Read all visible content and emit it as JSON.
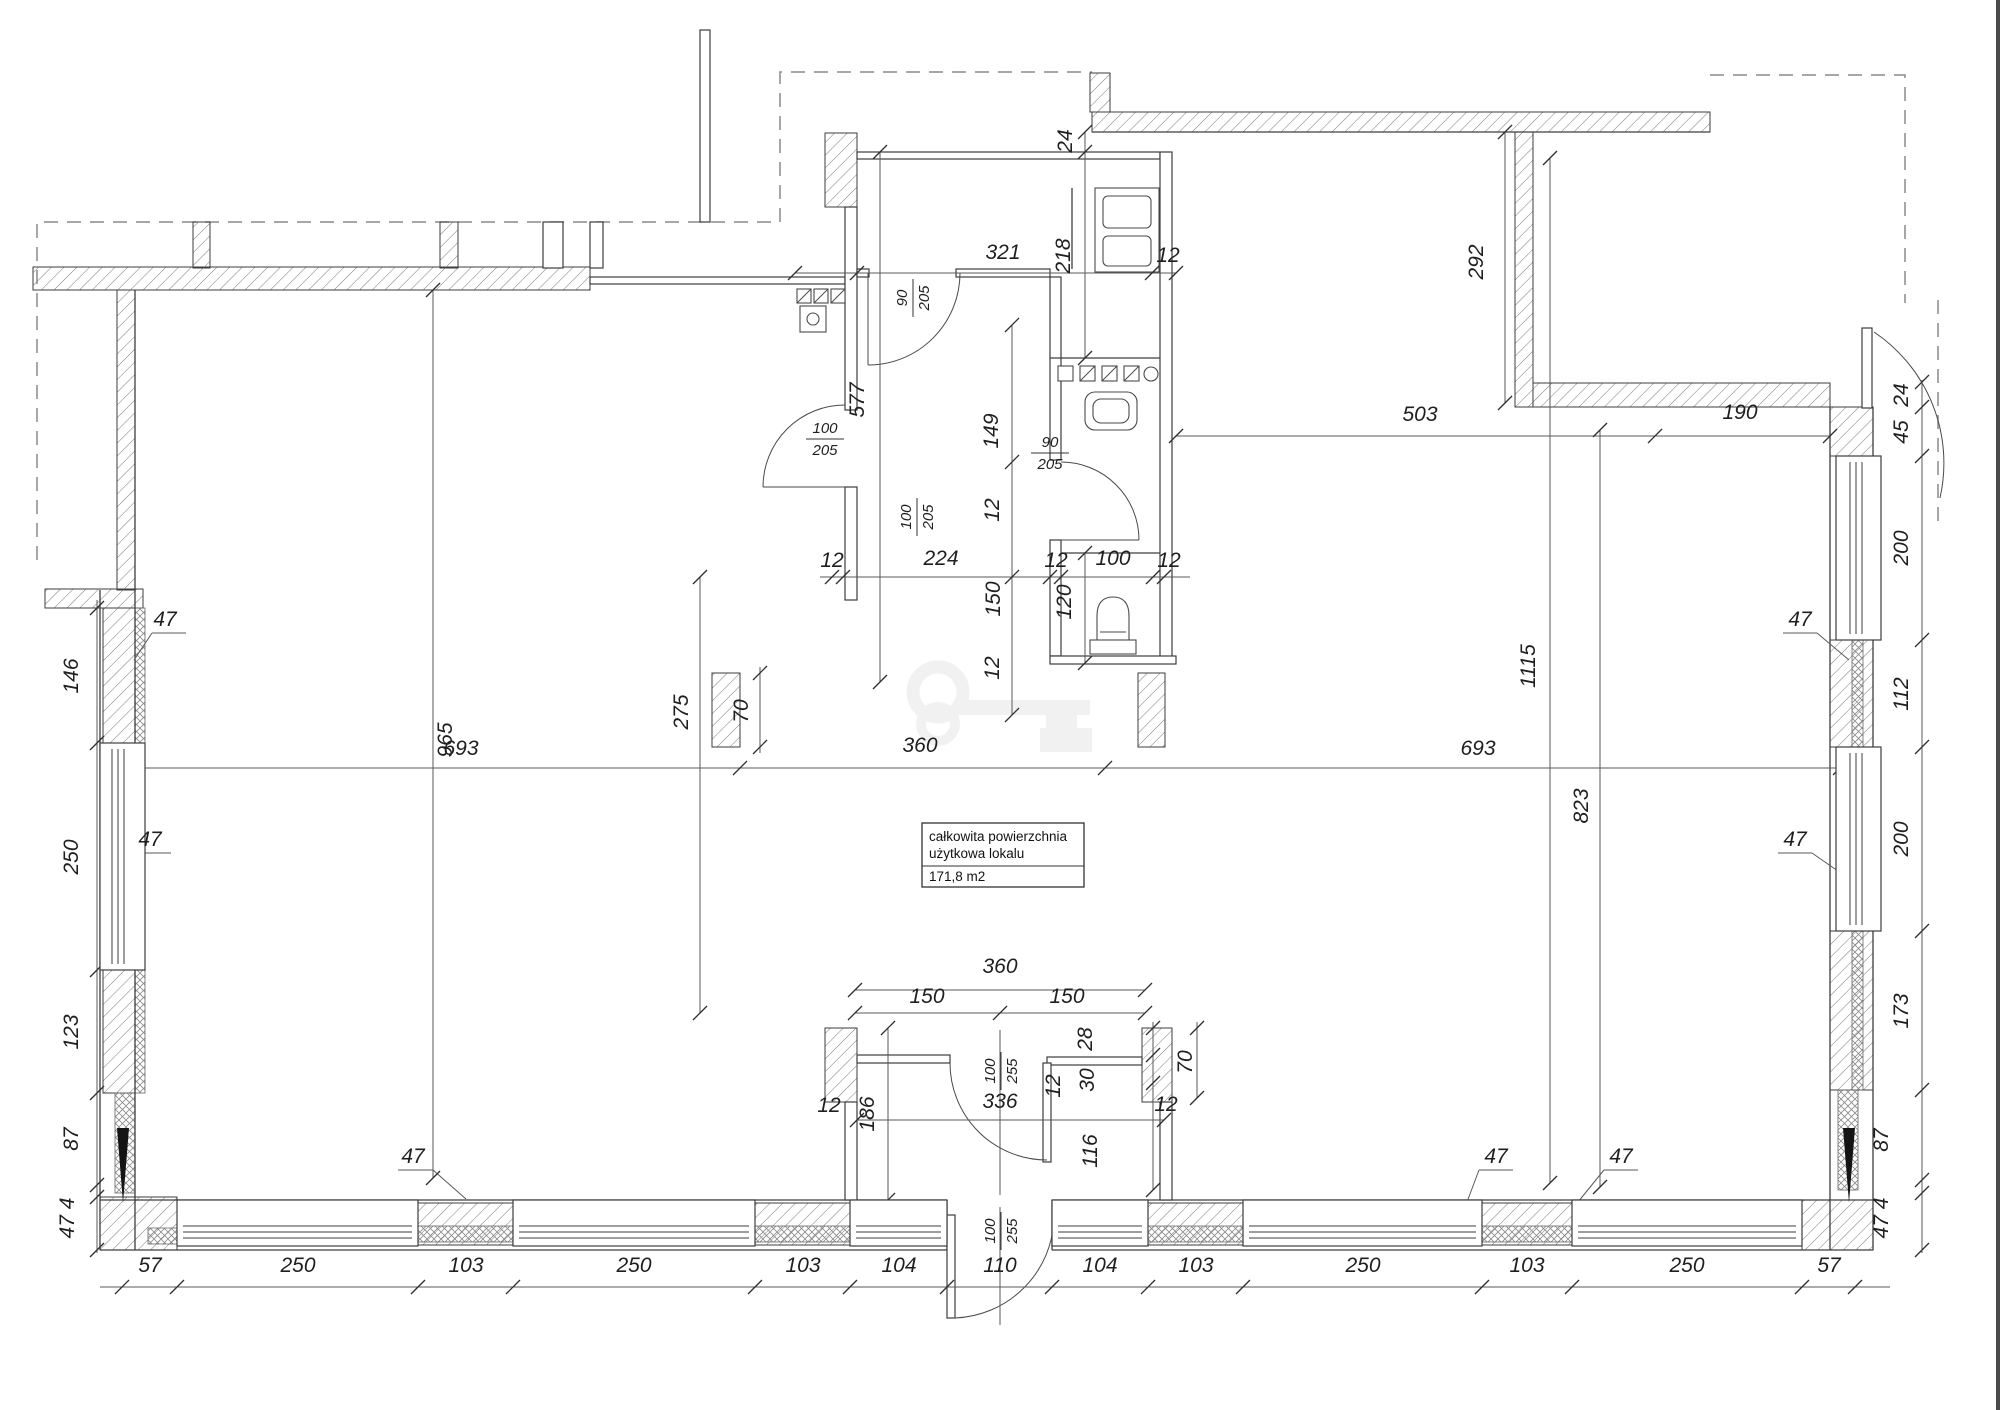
{
  "info_box": {
    "line1": "całkowita powierzchnia",
    "line2": "użytkowa lokalu",
    "area": "171,8 m2"
  },
  "colors": {
    "line": "#3d3d3d",
    "dimension": "#5a5a5a",
    "hatch": "#777777",
    "dashed_outline": "#8a8a8a",
    "watermark": "#f0f0f0",
    "background": "#ffffff"
  },
  "icons": [
    {
      "name": "key-watermark"
    },
    {
      "name": "toilet-icon"
    },
    {
      "name": "sink-icon"
    },
    {
      "name": "fridge-icon"
    },
    {
      "name": "burner-row-icon"
    },
    {
      "name": "vent-shaft-icon"
    }
  ],
  "labels": [
    {
      "t": "57",
      "x": 150,
      "y": 1272
    },
    {
      "t": "250",
      "x": 298,
      "y": 1272
    },
    {
      "t": "103",
      "x": 466,
      "y": 1272
    },
    {
      "t": "250",
      "x": 634,
      "y": 1272
    },
    {
      "t": "103",
      "x": 803,
      "y": 1272
    },
    {
      "t": "104",
      "x": 899,
      "y": 1272
    },
    {
      "t": "110",
      "x": 1000,
      "y": 1272
    },
    {
      "t": "104",
      "x": 1100,
      "y": 1272
    },
    {
      "t": "103",
      "x": 1196,
      "y": 1272
    },
    {
      "t": "250",
      "x": 1363,
      "y": 1272
    },
    {
      "t": "103",
      "x": 1527,
      "y": 1272
    },
    {
      "t": "250",
      "x": 1687,
      "y": 1272
    },
    {
      "t": "57",
      "x": 1829,
      "y": 1272
    },
    {
      "t": "146",
      "x": 78,
      "y": 676,
      "r": -90
    },
    {
      "t": "250",
      "x": 78,
      "y": 857,
      "r": -90
    },
    {
      "t": "123",
      "x": 78,
      "y": 1032,
      "r": -90
    },
    {
      "t": "87",
      "x": 78,
      "y": 1139,
      "r": -90
    },
    {
      "t": "47 4",
      "x": 74,
      "y": 1218,
      "r": -90
    },
    {
      "t": "24",
      "x": 1908,
      "y": 395,
      "r": -90
    },
    {
      "t": "45",
      "x": 1908,
      "y": 432,
      "r": -90
    },
    {
      "t": "200",
      "x": 1908,
      "y": 548,
      "r": -90
    },
    {
      "t": "112",
      "x": 1908,
      "y": 694,
      "r": -90
    },
    {
      "t": "200",
      "x": 1908,
      "y": 839,
      "r": -90
    },
    {
      "t": "173",
      "x": 1908,
      "y": 1011,
      "r": -90
    },
    {
      "t": "87",
      "x": 1888,
      "y": 1140,
      "r": -90
    },
    {
      "t": "47 4",
      "x": 1888,
      "y": 1218,
      "r": -90
    },
    {
      "t": "24",
      "x": 1072,
      "y": 141,
      "r": -90
    },
    {
      "t": "321",
      "x": 1003,
      "y": 259
    },
    {
      "t": "218",
      "x": 1070,
      "y": 256,
      "r": -90
    },
    {
      "t": "12",
      "x": 1168,
      "y": 262
    },
    {
      "t": "292",
      "x": 1483,
      "y": 262,
      "r": -90
    },
    {
      "t": "503",
      "x": 1420,
      "y": 421
    },
    {
      "t": "190",
      "x": 1740,
      "y": 419
    },
    {
      "t": "577",
      "x": 864,
      "y": 400,
      "r": -90
    },
    {
      "t": "149",
      "x": 998,
      "y": 431,
      "r": -90
    },
    {
      "t": "12",
      "x": 832,
      "y": 567
    },
    {
      "t": "224",
      "x": 941,
      "y": 565
    },
    {
      "t": "12",
      "x": 1056,
      "y": 567
    },
    {
      "t": "100",
      "x": 1113,
      "y": 565
    },
    {
      "t": "12",
      "x": 1169,
      "y": 567
    },
    {
      "t": "150",
      "x": 1000,
      "y": 599,
      "r": -90
    },
    {
      "t": "120",
      "x": 1071,
      "y": 602,
      "r": -90
    },
    {
      "t": "12",
      "x": 999,
      "y": 510,
      "r": -90
    },
    {
      "t": "12",
      "x": 999,
      "y": 668,
      "r": -90
    },
    {
      "t": "70",
      "x": 748,
      "y": 711,
      "r": -90
    },
    {
      "t": "70",
      "x": 1192,
      "y": 1062,
      "r": -90
    },
    {
      "t": "965",
      "x": 452,
      "y": 740,
      "r": -90
    },
    {
      "t": "275",
      "x": 688,
      "y": 712,
      "r": -90
    },
    {
      "t": "693",
      "x": 461,
      "y": 755
    },
    {
      "t": "360",
      "x": 920,
      "y": 752
    },
    {
      "t": "693",
      "x": 1478,
      "y": 755
    },
    {
      "t": "1115",
      "x": 1535,
      "y": 666,
      "r": -90
    },
    {
      "t": "823",
      "x": 1588,
      "y": 806,
      "r": -90
    },
    {
      "t": "360",
      "x": 1000,
      "y": 973
    },
    {
      "t": "150",
      "x": 927,
      "y": 1003
    },
    {
      "t": "150",
      "x": 1067,
      "y": 1003
    },
    {
      "t": "28",
      "x": 1092,
      "y": 1039,
      "r": -90
    },
    {
      "t": "30",
      "x": 1094,
      "y": 1080,
      "r": -90
    },
    {
      "t": "12",
      "x": 1060,
      "y": 1086,
      "r": -90
    },
    {
      "t": "186",
      "x": 874,
      "y": 1114,
      "r": -90
    },
    {
      "t": "336",
      "x": 1000,
      "y": 1108
    },
    {
      "t": "116",
      "x": 1097,
      "y": 1151,
      "r": -90
    },
    {
      "t": "12",
      "x": 829,
      "y": 1112
    },
    {
      "t": "12",
      "x": 1166,
      "y": 1111
    },
    {
      "t": "47",
      "x": 165,
      "y": 626
    },
    {
      "t": "47",
      "x": 150,
      "y": 846
    },
    {
      "t": "47",
      "x": 413,
      "y": 1163
    },
    {
      "t": "47",
      "x": 1496,
      "y": 1163
    },
    {
      "t": "47",
      "x": 1621,
      "y": 1163
    },
    {
      "t": "47",
      "x": 1800,
      "y": 626
    },
    {
      "t": "47",
      "x": 1795,
      "y": 846
    }
  ],
  "door_labels": [
    {
      "a": "90",
      "b": "205",
      "x": 912,
      "y": 298,
      "r": -90
    },
    {
      "a": "100",
      "b": "205",
      "x": 825,
      "y": 438,
      "r": 0
    },
    {
      "a": "100",
      "b": "205",
      "x": 916,
      "y": 517,
      "r": -90
    },
    {
      "a": "90",
      "b": "205",
      "x": 1050,
      "y": 452,
      "r": 0
    },
    {
      "a": "100",
      "b": "255",
      "x": 1000,
      "y": 1071,
      "r": -90
    },
    {
      "a": "100",
      "b": "255",
      "x": 1000,
      "y": 1231,
      "r": -90
    }
  ]
}
